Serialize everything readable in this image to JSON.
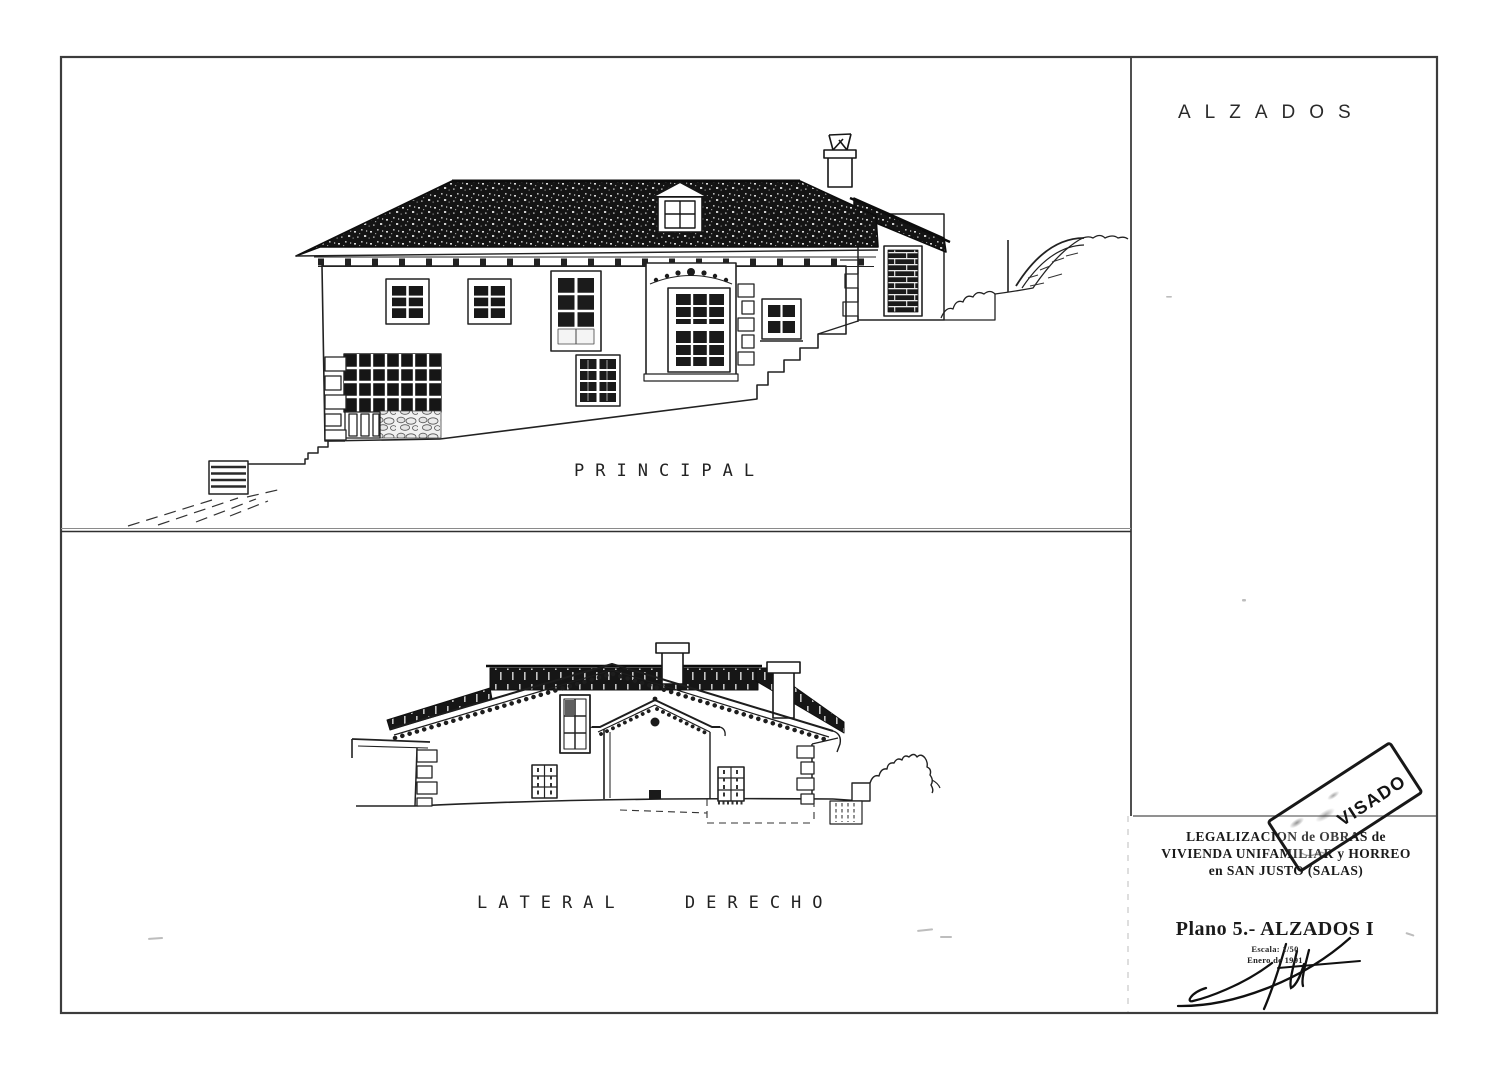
{
  "drawing_titles": {
    "sheet_title": "ALZADOS",
    "principal": "PRINCIPAL",
    "lateral": "LATERAL DERECHO"
  },
  "title_block": {
    "project_line1": "LEGALIZACION de OBRAS de",
    "project_line2": "VIVIENDA UNIFAMILIAR y HORREO",
    "project_line3": "en SAN JUSTO (SALAS)",
    "sheet_label": "Plano 5.- ALZADOS I",
    "scale_note": "Escala: 1/50",
    "date_note": "Enero de 1991"
  },
  "stamp": {
    "text": "VISADO"
  },
  "colors": {
    "ink": "#1c1c1c",
    "frame": "#3c3c3c",
    "roof": "#141414",
    "paper": "#ffffff"
  }
}
